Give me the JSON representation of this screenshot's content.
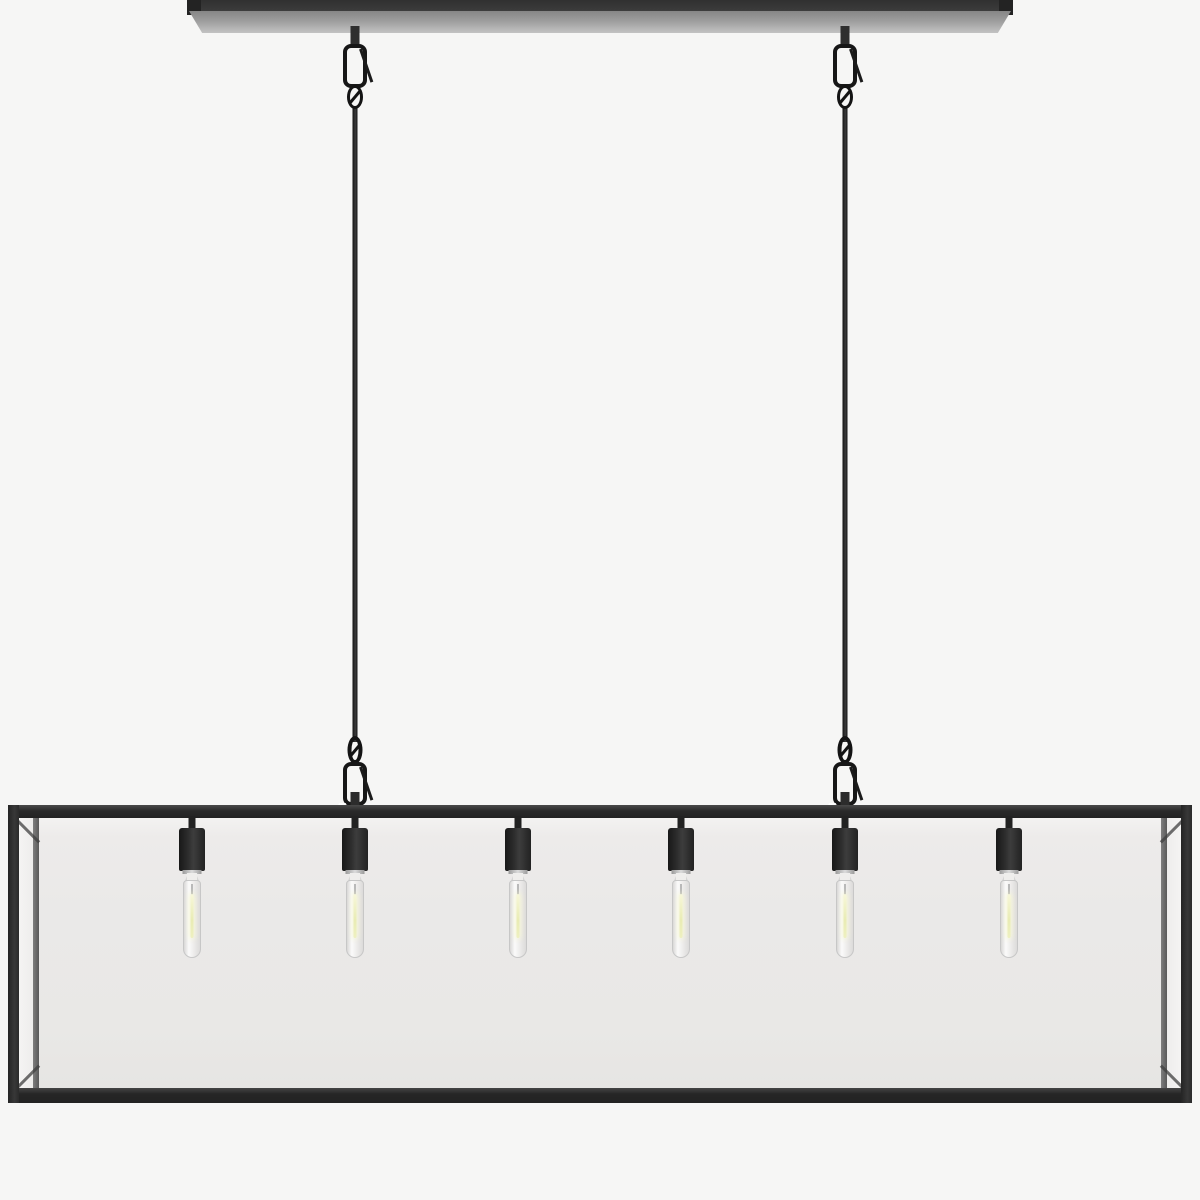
{
  "scene": {
    "kind": "3d-product-render",
    "subject": "Six-light linear chandelier: rectangular clear-glass box shade with matte black metal frame, suspended by two black cables with carabiner hooks and swivel loops from a slim rectangular ceiling canopy bar; six black cylindrical sockets holding clear tubular filament bulbs",
    "background_color": "#f6f6f5"
  },
  "colors": {
    "metal_dark": "#232323",
    "metal_mid": "#3a3a3a",
    "canopy_bevel_top": "#868686",
    "canopy_bevel_bottom": "#c3c3c3",
    "glass_fill": "#eae9e8",
    "glass_highlight": "#f4f3f2",
    "inner_post": "#4f4f4f",
    "socket_color": "#242424",
    "bulb_outline": "#c7c7c7",
    "filament_color": "#e9ecb4",
    "cable_color": "#1d1d1d"
  },
  "fixture": {
    "canopy_bar": {
      "x_left": 187,
      "x_right": 1013
    },
    "suspension_cables": {
      "count": 2,
      "x_centers": [
        355,
        845
      ]
    },
    "shade_frame": {
      "x_left": 8,
      "x_right": 1192,
      "y_top": 805,
      "y_bottom": 1103
    },
    "bulbs": {
      "count": 6,
      "x_centers": [
        192,
        355,
        518,
        681,
        845,
        1009
      ]
    }
  }
}
